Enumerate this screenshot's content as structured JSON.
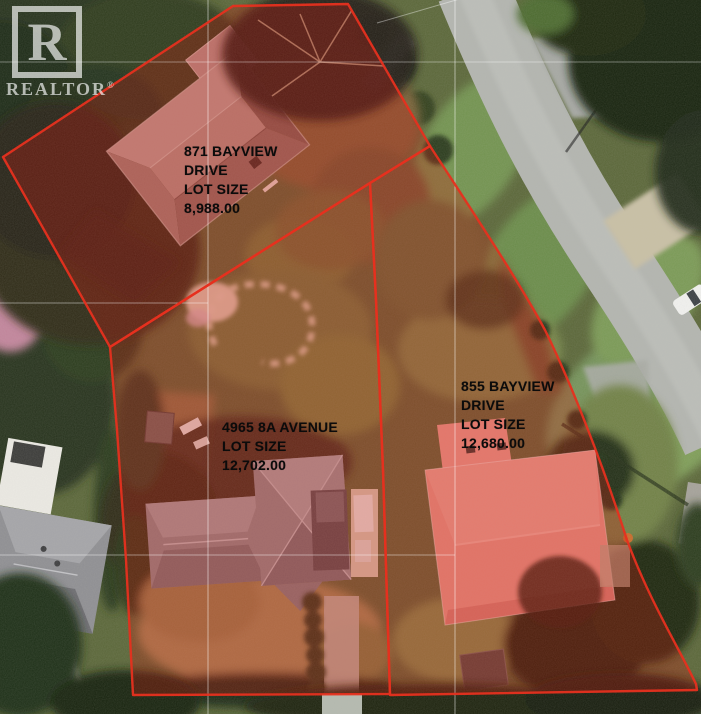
{
  "watermark": {
    "letter": "R",
    "wordmark": "REALTOR",
    "registered": "®"
  },
  "parcels": [
    {
      "name": "871-bayview-drive",
      "address": "871 BAYVIEW DRIVE",
      "lot_size": "8,988.00",
      "lines": [
        "871 BAYVIEW",
        "DRIVE",
        "LOT SIZE",
        "8,988.00"
      ]
    },
    {
      "name": "4965-8a-avenue",
      "address": "4965 8A AVENUE",
      "lot_size": "12,702.00",
      "lines": [
        "4965 8A AVENUE",
        "LOT SIZE",
        "12,702.00"
      ]
    },
    {
      "name": "855-bayview-drive",
      "address": "855 BAYVIEW DRIVE",
      "lot_size": "12,680.00",
      "lines": [
        "855 BAYVIEW",
        "DRIVE",
        "LOT SIZE",
        "12,680.00"
      ]
    }
  ],
  "colors": {
    "parcel_boundary": "#e6301f",
    "parcel_fill": "rgba(205,25,15,0.30)",
    "label_text": "#0b0b0b",
    "survey_line": "rgba(255,255,255,0.5)",
    "watermark": "rgba(255,255,255,0.82)"
  }
}
